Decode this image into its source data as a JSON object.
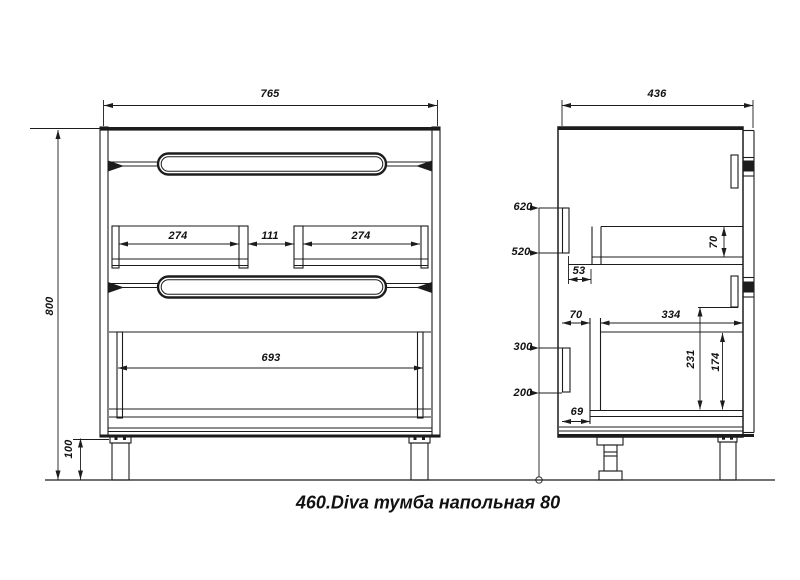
{
  "title": "460.Diva тумба напольная 80",
  "colors": {
    "line": "#1c1c1c",
    "background": "#ffffff"
  },
  "front_view": {
    "dims": {
      "width": "765",
      "height": "800",
      "leg_height": "100",
      "left_drawer_width": "274",
      "center_gap": "111",
      "right_drawer_width": "274",
      "bottom_drawer_width": "693"
    }
  },
  "side_view": {
    "dims": {
      "depth": "436",
      "height_620": "620",
      "height_520": "520",
      "height_300": "300",
      "height_200": "200",
      "back_gap_53": "53",
      "top_drawer_inner_height": "70",
      "back_gap_70": "70",
      "drawer_depth_334": "334",
      "inner_height_231": "231",
      "inner_height_174": "174",
      "back_gap_69": "69"
    }
  }
}
